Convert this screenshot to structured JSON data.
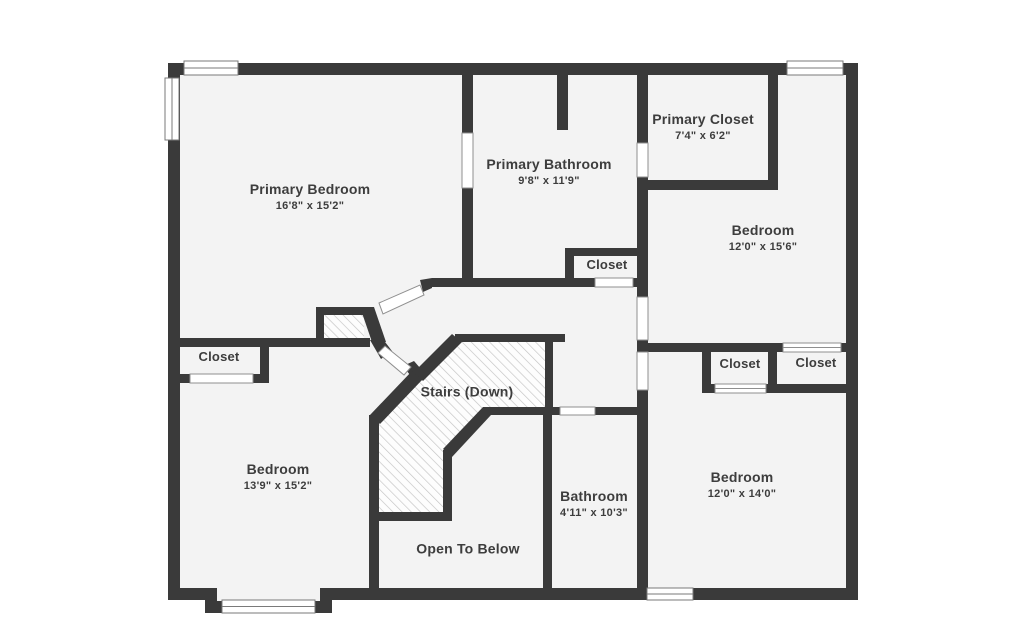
{
  "plan": {
    "type": "floor-plan",
    "colors": {
      "wall": "#3a3a3a",
      "floor": "#f3f3f3",
      "hatch_line": "#c3c3c3",
      "door_window_trim": "#8f8f8f",
      "label_text": "#3d3d3d",
      "background": "#ffffff"
    }
  },
  "rooms": [
    {
      "id": "primary-bedroom",
      "name": "Primary Bedroom",
      "dims": "16'8\" x 15'2\""
    },
    {
      "id": "primary-bathroom",
      "name": "Primary Bathroom",
      "dims": "9'8\" x 11'9\""
    },
    {
      "id": "primary-closet",
      "name": "Primary Closet",
      "dims": "7'4\" x 6'2\""
    },
    {
      "id": "bedroom-top-right",
      "name": "Bedroom",
      "dims": "12'0\" x 15'6\""
    },
    {
      "id": "closet-hall",
      "name": "Closet",
      "dims": ""
    },
    {
      "id": "closet-left",
      "name": "Closet",
      "dims": ""
    },
    {
      "id": "bedroom-bottom-left",
      "name": "Bedroom",
      "dims": "13'9\" x 15'2\""
    },
    {
      "id": "stairs",
      "name": "Stairs (Down)",
      "dims": ""
    },
    {
      "id": "open-to-below",
      "name": "Open To Below",
      "dims": ""
    },
    {
      "id": "bathroom",
      "name": "Bathroom",
      "dims": "4'11\" x 10'3\""
    },
    {
      "id": "closet-mid-right",
      "name": "Closet",
      "dims": ""
    },
    {
      "id": "closet-far-right",
      "name": "Closet",
      "dims": ""
    },
    {
      "id": "bedroom-bottom-right",
      "name": "Bedroom",
      "dims": "12'0\" x 14'0\""
    }
  ]
}
